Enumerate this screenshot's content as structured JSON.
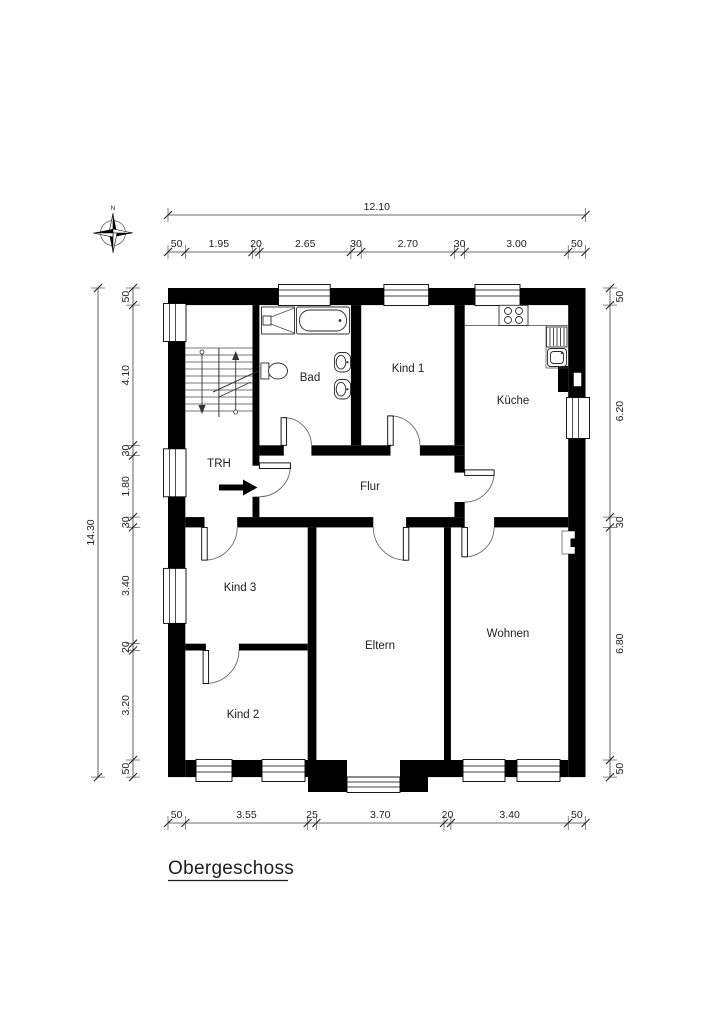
{
  "title": "Obergeschoss",
  "compass": {
    "north_label": "N"
  },
  "rooms": {
    "trh": "TRH",
    "bad": "Bad",
    "kind1": "Kind 1",
    "kueche": "Küche",
    "flur": "Flur",
    "kind3": "Kind 3",
    "kind2": "Kind 2",
    "eltern": "Eltern",
    "wohnen": "Wohnen"
  },
  "dimensions": {
    "top": {
      "total": "12.10",
      "segments": [
        "50",
        "1.95",
        "20",
        "2.65",
        "30",
        "2.70",
        "30",
        "3.00",
        "50"
      ]
    },
    "left": {
      "total": "14.30",
      "segments": [
        "50",
        "4.10",
        "30",
        "1.80",
        "30",
        "3.40",
        "20",
        "3.20",
        "50"
      ]
    },
    "right": {
      "segments": [
        "50",
        "6.20",
        "30",
        "6.80",
        "50"
      ]
    },
    "bottom": {
      "segments": [
        "50",
        "3.55",
        "25",
        "3.70",
        "20",
        "3.40",
        "50"
      ]
    }
  }
}
